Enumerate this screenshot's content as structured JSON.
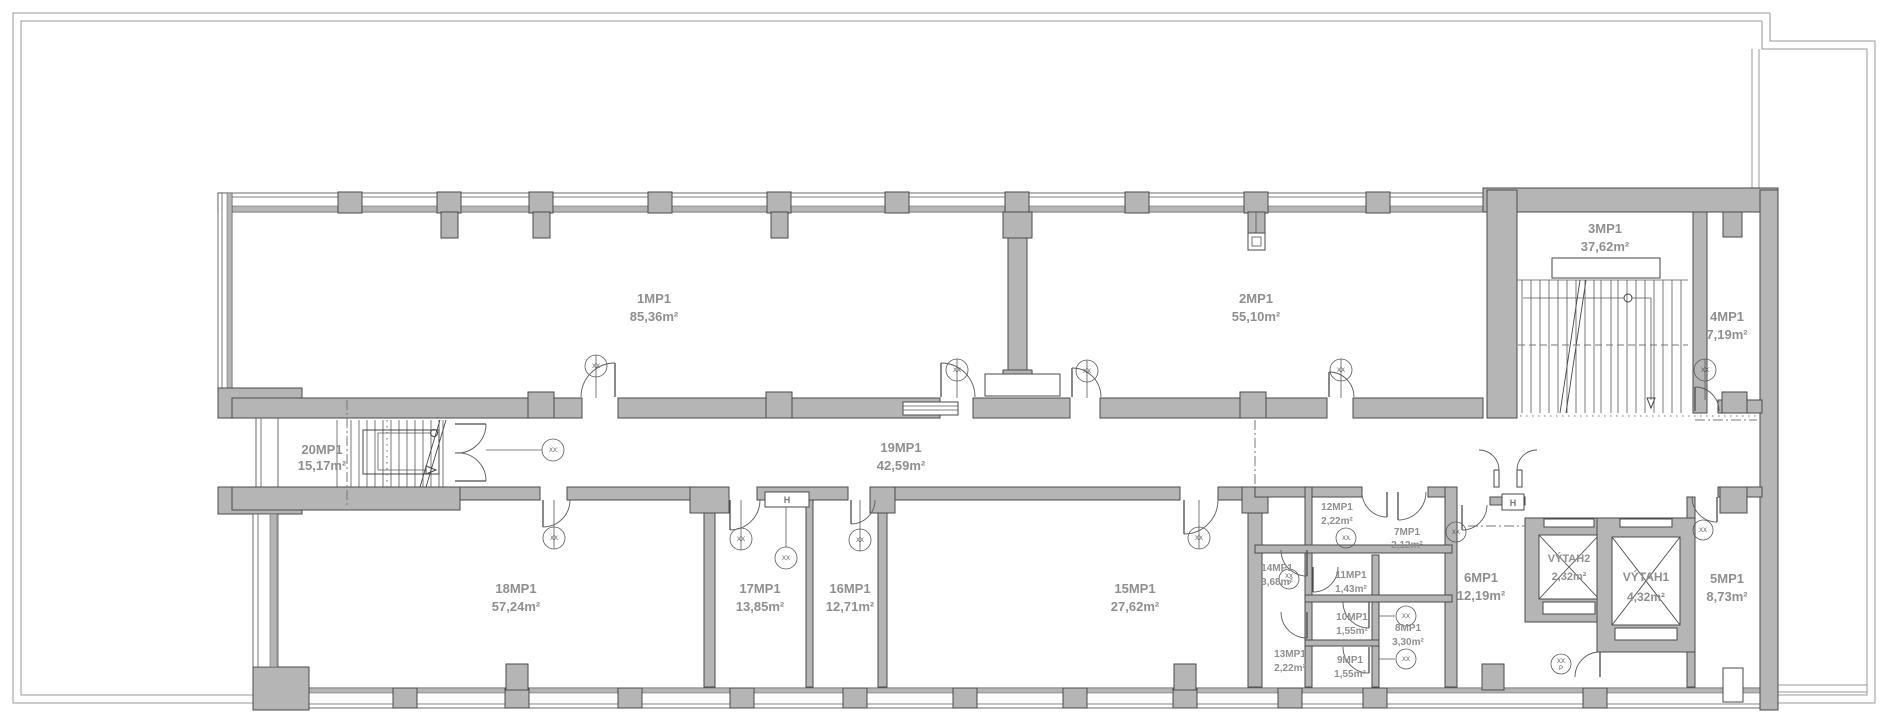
{
  "plan": {
    "rooms": [
      {
        "label": "1MP1",
        "area": "85,36m²"
      },
      {
        "label": "2MP1",
        "area": "55,10m²"
      },
      {
        "label": "3MP1",
        "area": "37,62m²"
      },
      {
        "label": "4MP1",
        "area": "7,19m²"
      },
      {
        "label": "5MP1",
        "area": "8,73m²"
      },
      {
        "label": "6MP1",
        "area": "12,19m²"
      },
      {
        "label": "7MP1",
        "area": "2,12m²"
      },
      {
        "label": "8MP1",
        "area": "3,30m²"
      },
      {
        "label": "9MP1",
        "area": "1,55m²"
      },
      {
        "label": "10MP1",
        "area": "1,55m²"
      },
      {
        "label": "11MP1",
        "area": "1,43m²"
      },
      {
        "label": "12MP1",
        "area": "2,22m²"
      },
      {
        "label": "13MP1",
        "area": "2,22m²"
      },
      {
        "label": "14MP1",
        "area": "3,68m²"
      },
      {
        "label": "15MP1",
        "area": "27,62m²"
      },
      {
        "label": "16MP1",
        "area": "12,71m²"
      },
      {
        "label": "17MP1",
        "area": "13,85m²"
      },
      {
        "label": "18MP1",
        "area": "57,24m²"
      },
      {
        "label": "19MP1",
        "area": "42,59m²"
      },
      {
        "label": "20MP1",
        "area": "15,17m²"
      }
    ],
    "elevators": [
      {
        "label": "VÝTAH1",
        "area": "4,32m²"
      },
      {
        "label": "VÝTAH2",
        "area": "2,32m²"
      }
    ],
    "wall_markers": [
      {
        "label": "H"
      },
      {
        "label": "H"
      }
    ],
    "symbols": {
      "door_tag": "XX",
      "p_tag": "P"
    },
    "colors": {
      "wall": "#b5b5b5",
      "outline": "#4a4a4a",
      "label_text": "#8f8f8f",
      "boundary_line": "#9a9a9a"
    }
  }
}
